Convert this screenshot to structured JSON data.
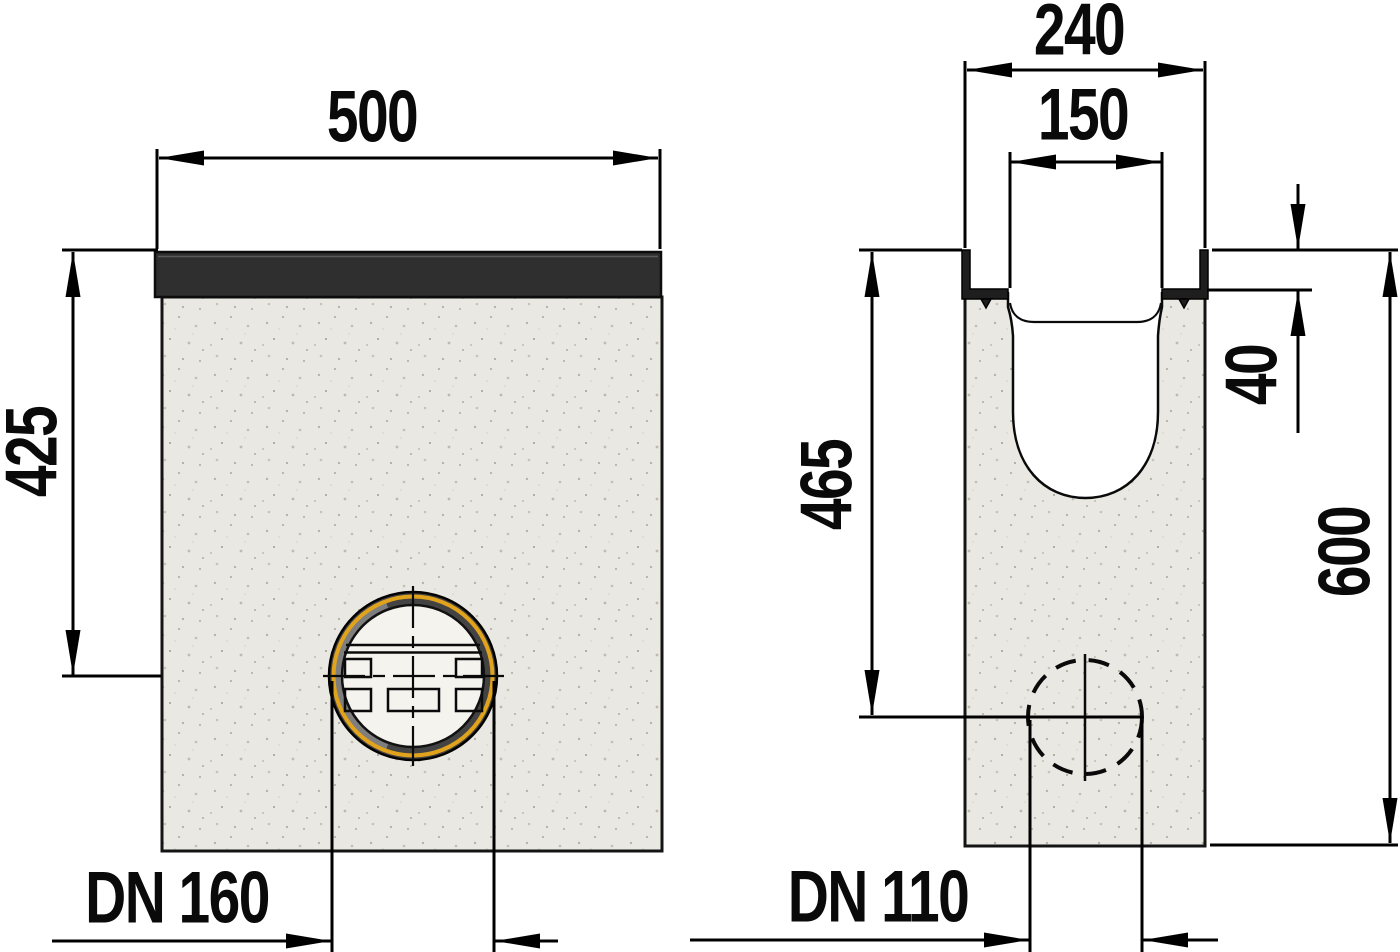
{
  "drawing_type": "technical-dimension-drawing",
  "labels": {
    "front_width": "500",
    "front_height_to_outlet": "425",
    "front_outlet": "DN 160",
    "side_outer_width": "240",
    "side_channel_width": "150",
    "side_rail_height": "40",
    "side_height_to_outlet": "465",
    "side_total_height": "600",
    "side_outlet": "DN 110"
  },
  "colors": {
    "line": "#000000",
    "concrete": "#e9e8e2",
    "concrete_speckle": "#b6b4a9",
    "grate": "#2f2f2f",
    "rail": "#1e1e1e",
    "gasket_ring": "#e2a31c",
    "socket_ring": "#434343",
    "socket_face": "#f4f3ee",
    "cut_void": "#ffffff"
  }
}
